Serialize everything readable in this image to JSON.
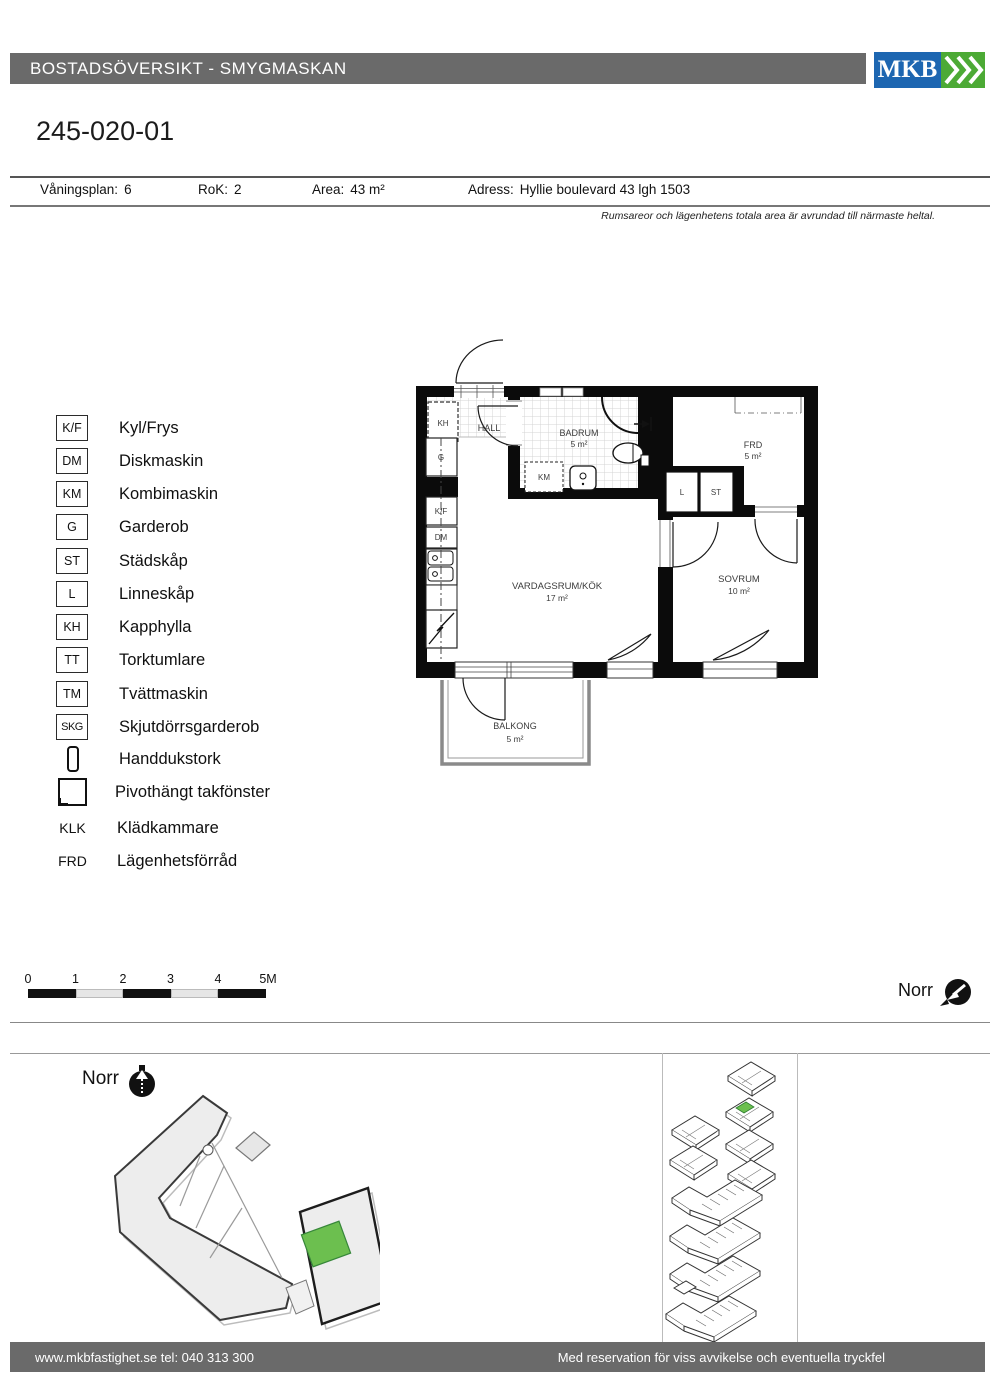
{
  "colors": {
    "header_bar": "#6a6a6a",
    "logo_blue": "#1d66b1",
    "logo_green": "#4caa35",
    "unit_green": "#6cbf4f"
  },
  "header": {
    "title": "BOSTADSÖVERSIKT - SMYGMASKAN",
    "logo_text": "MKB"
  },
  "apartment": {
    "id": "245-020-01",
    "fields": [
      {
        "label": "Våningsplan:",
        "value": "6"
      },
      {
        "label": "RoK:",
        "value": "2"
      },
      {
        "label": "Area:",
        "value": "43 m²"
      },
      {
        "label": "Adress:",
        "value": "Hyllie boulevard 43  lgh 1503"
      }
    ],
    "note": "Rumsareor och lägenhetens totala area är avrundad till närmaste heltal."
  },
  "legend": {
    "items": [
      {
        "symbol": "K/F",
        "label": "Kyl/Frys",
        "boxed": true
      },
      {
        "symbol": "DM",
        "label": "Diskmaskin",
        "boxed": true
      },
      {
        "symbol": "KM",
        "label": "Kombimaskin",
        "boxed": true
      },
      {
        "symbol": "G",
        "label": "Garderob",
        "boxed": true
      },
      {
        "symbol": "ST",
        "label": "Städskåp",
        "boxed": true
      },
      {
        "symbol": "L",
        "label": "Linneskåp",
        "boxed": true
      },
      {
        "symbol": "KH",
        "label": "Kapphylla",
        "boxed": true
      },
      {
        "symbol": "TT",
        "label": "Torktumlare",
        "boxed": true
      },
      {
        "symbol": "TM",
        "label": "Tvättmaskin",
        "boxed": true
      },
      {
        "symbol": "SKG",
        "label": "Skjutdörrsgarderob",
        "boxed": true
      },
      {
        "symbol": null,
        "icon": "handdukstork-icon",
        "label": "Handdukstork",
        "boxed": false
      },
      {
        "symbol": null,
        "icon": "roof-window-icon",
        "label": "Pivothängt takfönster",
        "boxed": false
      },
      {
        "symbol": "KLK",
        "label": "Klädkammare",
        "boxed": false
      },
      {
        "symbol": "FRD",
        "label": "Lägenhetsförråd",
        "boxed": false
      }
    ]
  },
  "floorplan": {
    "rooms": {
      "hall": {
        "name": "HALL"
      },
      "badrum": {
        "name": "BADRUM",
        "area": "5 m²"
      },
      "frd": {
        "name": "FRD",
        "area": "5 m²"
      },
      "vardagsrum": {
        "name": "VARDAGSRUM/KÖK",
        "area": "17 m²"
      },
      "sovrum": {
        "name": "SOVRUM",
        "area": "10 m²"
      },
      "balkong": {
        "name": "BALKONG",
        "area": "5 m²"
      }
    },
    "fixtures": {
      "kh": "KH",
      "g": "G",
      "kf": "K/F",
      "dm": "DM",
      "km": "KM",
      "l": "L",
      "st": "ST"
    }
  },
  "scalebar": {
    "ticks": [
      "0",
      "1",
      "2",
      "3",
      "4",
      "5M"
    ]
  },
  "compass": {
    "plan_label": "Norr",
    "site_label": "Norr"
  },
  "footer": {
    "left": "www.mkbfastighet.se tel: 040 313 300",
    "right": "Med reservation för viss avvikelse och eventuella tryckfel"
  }
}
